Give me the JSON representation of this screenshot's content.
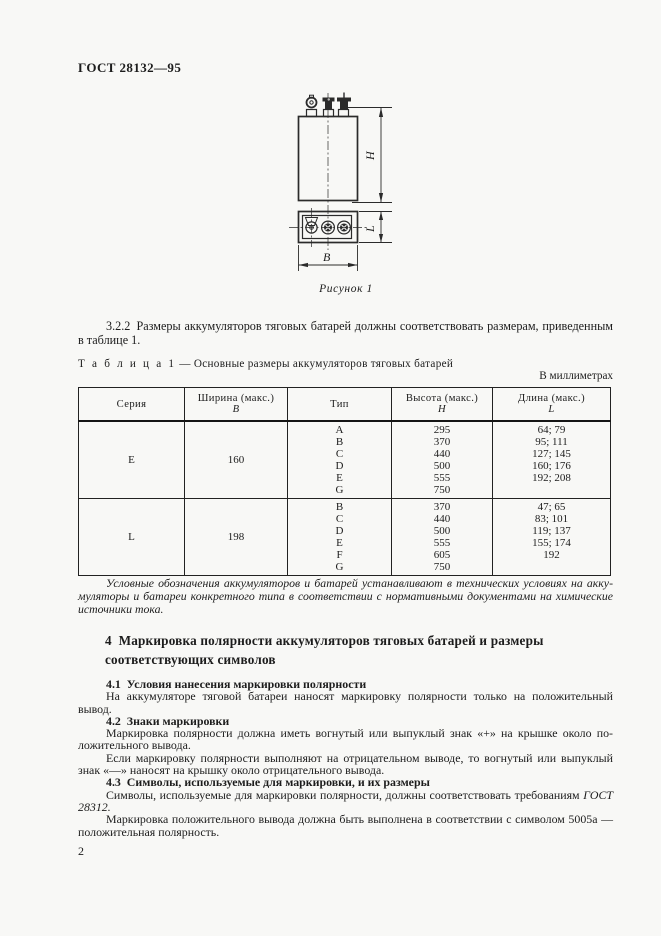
{
  "page": {
    "background": "#f8f8f6",
    "header": "ГОСТ 28132—95",
    "page_number": "2"
  },
  "figure": {
    "caption": "Рисунок 1",
    "dim_height": "H",
    "dim_length": "L",
    "dim_width": "B"
  },
  "paragraph_3_2_2": "3.2.2 Размеры аккумуляторов тяговых батарей должны соответствовать размерам, приведен­ным в таблице 1.",
  "table": {
    "title_label": "Т а б л и ц а   1",
    "title_text": " — Основные размеры аккумуляторов тяговых батарей",
    "units_note": "В миллиметрах",
    "headers": {
      "series": "Серия",
      "width": "Ширина (макс.)",
      "width_symbol": "В",
      "type": "Тип",
      "height": "Высота (макс.)",
      "height_symbol": "Н",
      "length": "Длина (макс.)",
      "length_symbol": "L"
    },
    "sections": [
      {
        "series": "Е",
        "width": "160",
        "types": [
          "A",
          "B",
          "C",
          "D",
          "E",
          "G"
        ],
        "heights": [
          "295",
          "370",
          "440",
          "500",
          "555",
          "750"
        ],
        "lengths": [
          "64; 79",
          "95; 111",
          "127; 145",
          "160; 176",
          "192; 208",
          ""
        ]
      },
      {
        "series": "L",
        "width": "198",
        "types": [
          "B",
          "C",
          "D",
          "E",
          "F",
          "G"
        ],
        "heights": [
          "370",
          "440",
          "500",
          "555",
          "605",
          "750"
        ],
        "lengths": [
          "47; 65",
          "83; 101",
          "119; 137",
          "155; 174",
          "192",
          ""
        ]
      }
    ]
  },
  "note": "Условные обозначения аккумуляторов и батарей устанавливают в технических условиях на акку­муляторы и батареи конкретного типа в соответствии с нормативными документами на химические источники тока.",
  "section_4": {
    "heading": "4 Маркировка полярности аккумуляторов тяговых батарей и размеры соответствующих символов",
    "s41_heading": "4.1 Условия нанесения маркировки полярности",
    "s41_body": "На аккумуляторе тяговой батареи наносят маркировку полярности только на положительный вывод.",
    "s42_heading": "4.2 Знаки маркировки",
    "s42_body1": "Маркировка полярности должна иметь вогнутый или выпуклый знак «+» на крышке около по­ложительного вывода.",
    "s42_body2": "Если маркировку полярности выполняют на отрицательном выводе, то вогнутый или выпук­лый знак «—» наносят на крышку около отрицательного вывода.",
    "s43_heading": "4.3 Символы, используемые для маркировки, и их размеры",
    "s43_body1_text": "Символы, используемые для маркировки полярности, должны соответствовать требованиям ",
    "s43_body1_ref": "ГОСТ 28312.",
    "s43_body2": "Маркировка положительного вывода должна быть выполнена в соответствии с символом 5005а — положительная полярность."
  }
}
